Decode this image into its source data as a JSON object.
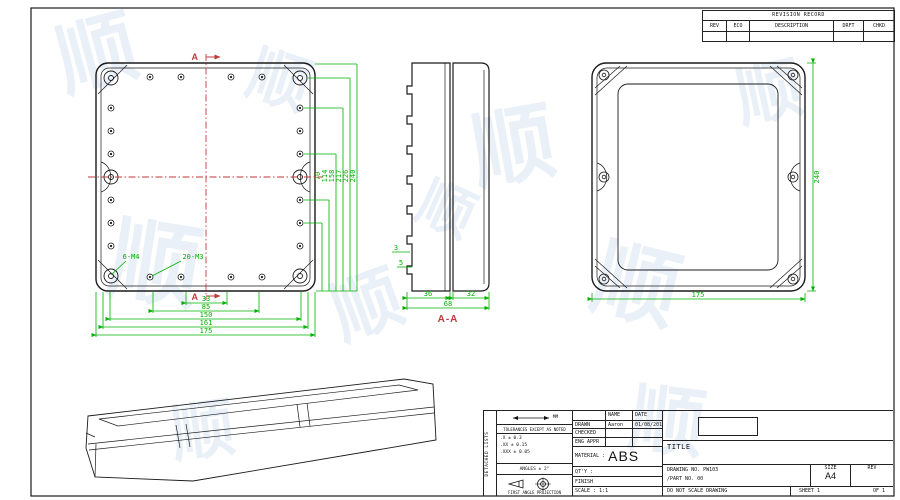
{
  "revision_table": {
    "title": "REVISION RECORD",
    "columns": [
      "REV",
      "ECO",
      "DESCRIPTION",
      "DRFT",
      "CHKD"
    ]
  },
  "front_view": {
    "section_label_top": "A",
    "section_label_bottom": "A",
    "corner_thread_label": "6-M4",
    "perimeter_thread_label": "20-M3",
    "vertical_dims": [
      "70",
      "114",
      "158",
      "217",
      "226",
      "240"
    ],
    "horizontal_dims": [
      "33",
      "85",
      "150",
      "161",
      "175"
    ]
  },
  "section_view": {
    "label": "A-A",
    "width_left": "36",
    "width_right": "32",
    "width_total": "68",
    "wall_dim": "3",
    "boss_dim": "5"
  },
  "back_view": {
    "height_dim": "240",
    "width_dim": "175"
  },
  "title_block": {
    "side_label": "DETACHED LISTS",
    "tolerance": {
      "units_label": "MM",
      "heading": "TOLERANCES EXCEPT AS NOTED",
      "rows": [
        ".X ± 0.3",
        ".XX ± 0.15",
        ".XXX ± 0.05"
      ],
      "angles": "ANGLES ± 2°",
      "projection": "FIRST ANGLE PROJECTION"
    },
    "approvals": {
      "name_header": "NAME",
      "date_header": "DATE",
      "rows": [
        {
          "role": "DRAWN",
          "name": "Aaron",
          "date": "01/08/2015"
        },
        {
          "role": "CHECKED",
          "name": "",
          "date": ""
        },
        {
          "role": "ENG APPR",
          "name": "",
          "date": ""
        }
      ]
    },
    "material_label": "MATERIAL :",
    "material_value": "ABS",
    "qty_label": "QT'Y :",
    "finish_label": "FINISH",
    "scale_label": "SCALE : 1:1",
    "title_label": "TITLE",
    "drawing_no_label": "DRAWING NO.",
    "drawing_no": "PW103",
    "part_no_label": "/PART NO.",
    "part_no": "00",
    "size_label": "SIZE",
    "size_value": "A4",
    "rev_label": "REV",
    "no_scale_note": "DO NOT SCALE DRAWING",
    "sheet_label": "SHEET 1",
    "of_label": "OF 1"
  },
  "watermark": {
    "glyphs": [
      "顺",
      "顺",
      "顺",
      "顺",
      "顺",
      "顺",
      "顺",
      "顺",
      "顺",
      "顺"
    ]
  },
  "colors": {
    "dimension_green": "#00b000",
    "section_red": "#c03a3a",
    "line_black": "#1a1a1a",
    "watermark_blue": "#7da2d4"
  }
}
